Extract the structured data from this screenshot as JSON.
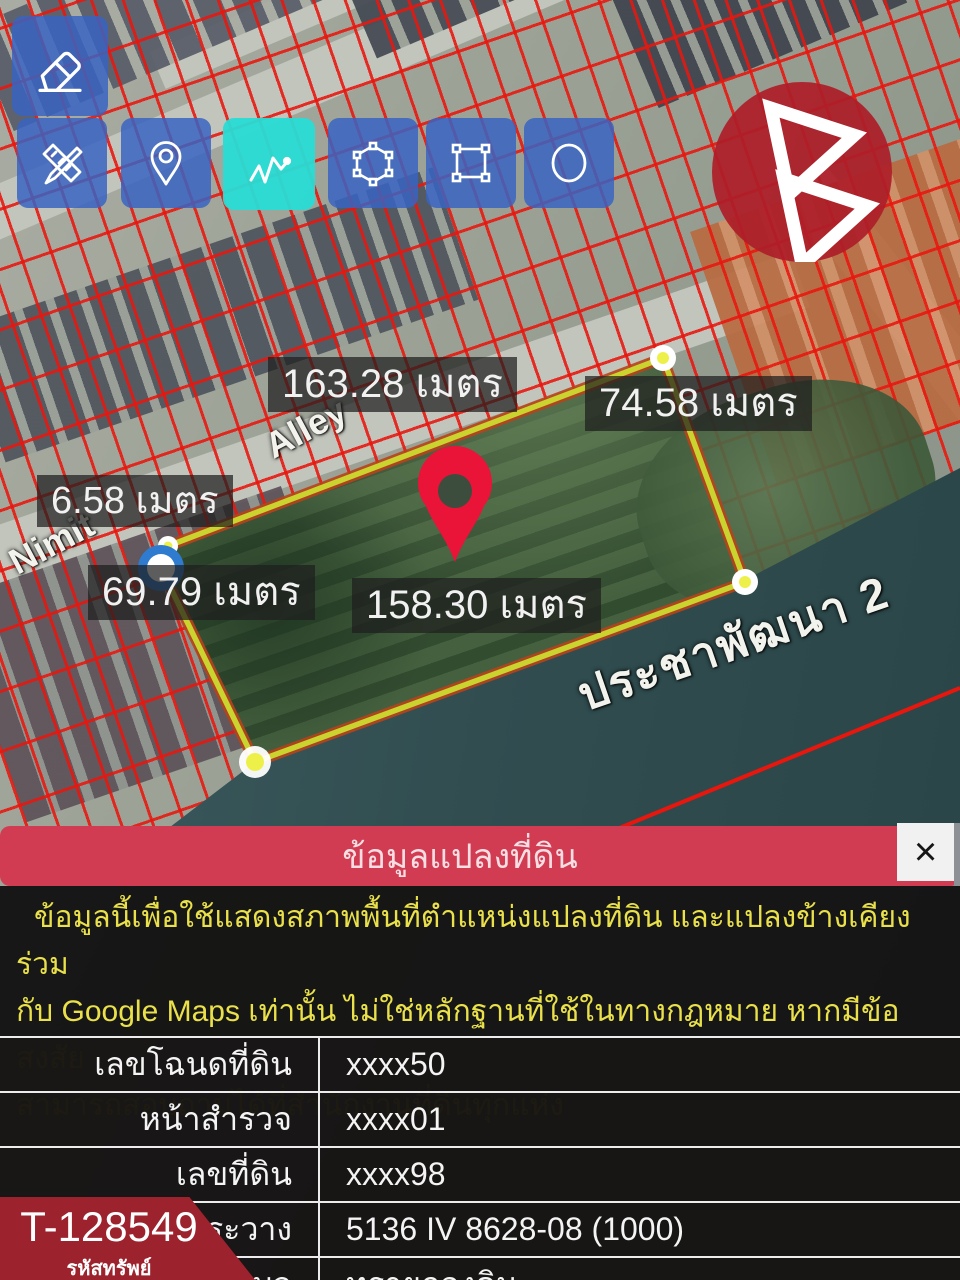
{
  "toolbar": {
    "buttons": [
      {
        "id": "eraser",
        "label": "eraser tool"
      },
      {
        "id": "measure",
        "label": "measure tool"
      },
      {
        "id": "marker",
        "label": "marker tool"
      },
      {
        "id": "polyline",
        "label": "polyline tool",
        "active": true
      },
      {
        "id": "polygon",
        "label": "polygon tool"
      },
      {
        "id": "rectangle",
        "label": "rectangle tool"
      },
      {
        "id": "circle",
        "label": "circle tool"
      }
    ]
  },
  "map": {
    "street_labels": {
      "alley": "Alley",
      "nimit": "Nimit",
      "canal_road": "ประชาพัฒนา 2"
    },
    "measurements": {
      "top": "163.28 เมตร",
      "right": "74.58 เมตร",
      "left_short": "6.58 เมตร",
      "left": "69.79 เมตร",
      "bottom": "158.30 เมตร"
    }
  },
  "panel": {
    "title": "ข้อมูลแปลงที่ดิน",
    "close": "×",
    "disclaimer": {
      "line1": "ข้อมูลนี้เพื่อใช้แสดงสภาพพื้นที่ตำแหน่งแปลงที่ดิน และแปลงข้างเคียงร่วม",
      "line2": "กับ Google Maps เท่านั้น ไม่ใช่หลักฐานที่ใช้ในทางกฎหมาย หากมีข้อสงสัย",
      "line3": "สามารถสอบถามได้ที่สำนักงานที่ดินทุกแห่ง"
    },
    "table": {
      "rows": [
        {
          "label": "เลขโฉนดที่ดิน",
          "value": "xxxx50"
        },
        {
          "label": "หน้าสำรวจ",
          "value": "xxxx01"
        },
        {
          "label": "เลขที่ดิน",
          "value": "xxxx98"
        },
        {
          "label": "ระวาง",
          "value": "5136 IV 8628-08 (1000)"
        },
        {
          "label": "ตำบล",
          "value": "ทรายกองดิน"
        }
      ]
    }
  },
  "badge": {
    "code": "T-128549",
    "caption": "รหัสทรัพย์"
  },
  "colors": {
    "header_red": "#d23c52",
    "badge_red": "#9c222d",
    "toolbar_blue": "#3a66c0",
    "active_cyan": "#28dcd5",
    "parcel_yellow": "#cbd32f",
    "grid_red": "#e9160e",
    "water_teal": "#314d50",
    "warning_yellow": "#e9e04a",
    "logo_red": "#ad1e29"
  }
}
